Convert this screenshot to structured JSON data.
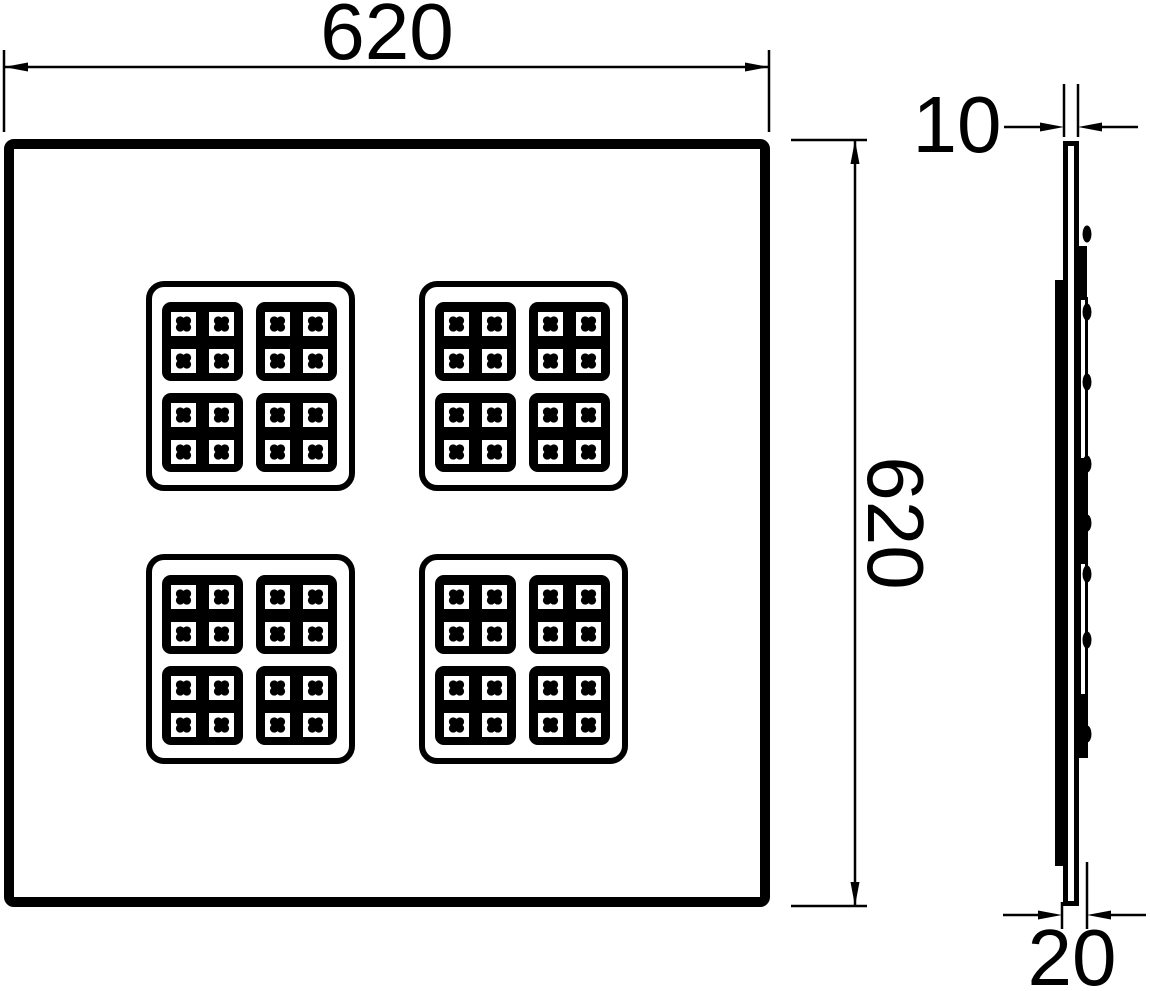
{
  "drawing": {
    "type": "technical-dimension-drawing",
    "subject": "square LED panel light, front view and side profile view",
    "dimensions": {
      "front_width": "620",
      "front_height": "620",
      "side_thickness": "10",
      "side_depth": "20"
    },
    "front_view": {
      "led_cluster_count": 4,
      "modules_per_cluster": 4,
      "leds_per_module": 4
    },
    "colors": {
      "line": "#000000",
      "background": "#ffffff"
    }
  }
}
